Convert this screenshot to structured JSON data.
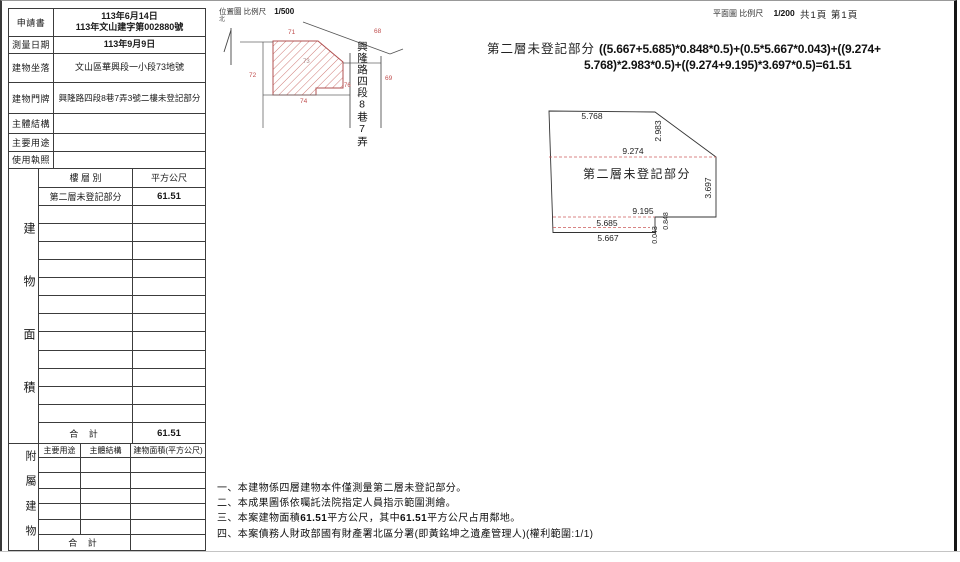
{
  "page": {
    "plan_scale_label": "平面圖 比例尺",
    "plan_scale_value": "1/200",
    "pages_label": "共1頁 第1頁"
  },
  "info_table": {
    "rows": [
      {
        "label": "申請書",
        "value_line1": "113年6月14日",
        "value_line2": "113年文山建字第002880號"
      },
      {
        "label": "測量日期",
        "value": "113年9月9日"
      },
      {
        "label": "建物坐落",
        "value": "文山區華興段一小段73地號"
      },
      {
        "label": "建物門牌",
        "value": "興隆路四段8巷7弄3號二樓未登記部分"
      },
      {
        "label": "主體結構",
        "value": ""
      },
      {
        "label": "主要用途",
        "value": ""
      },
      {
        "label": "使用執照",
        "value": ""
      }
    ]
  },
  "area_table": {
    "side_label": "建物面積",
    "col_floor": "樓 層 別",
    "col_area": "平方公尺",
    "row_floor": "第二層未登記部分",
    "row_area": "61.51",
    "total_label": "合  計",
    "total_value": "61.51"
  },
  "annex_table": {
    "side_label": "附屬建物",
    "col_use": "主要用途",
    "col_structure": "主體結構",
    "col_area": "建物面積(平方公尺)",
    "total_label": "合  計"
  },
  "location_map": {
    "title": "位置圖",
    "scale_label": "比例尺",
    "scale_value": "1/500",
    "north": "北",
    "street": "興隆路四段8巷7弄",
    "parcels": {
      "subject": "73",
      "p71": "71",
      "p72": "72",
      "p74": "74",
      "p68": "68",
      "p69": "69",
      "p76": "76"
    }
  },
  "floor_plan": {
    "region_label": "第二層未登記部分",
    "dim_top": "5.768",
    "dim_diag": "2.983",
    "dim_width_upper": "9.274",
    "dim_right": "3.697",
    "dim_width_lower": "9.195",
    "dim_mid": "5.685",
    "dim_bottom": "5.667",
    "dim_step": "0.848",
    "dim_tiny": "0.043"
  },
  "formula": {
    "label": "第二層未登記部分",
    "line1": "((5.667+5.685)*0.848*0.5)+(0.5*5.667*0.043)+((9.274+",
    "line2": "5.768)*2.983*0.5)+((9.274+9.195)*3.697*0.5)=61.51"
  },
  "notes": {
    "line1": "一、本建物係四層建物本件僅測量第二層未登記部分。",
    "line2": "二、本成果圖係依囑託法院指定人員指示範圍測繪。",
    "line3_parts": [
      "三、本案建物面積",
      "61.51",
      "平方公尺，其中",
      "61.51",
      "平方公尺占用鄰地。"
    ],
    "line4": "四、本案債務人財政部國有財產署北區分署(即黃銘坤之遺產管理人)(權利範圍:1/1)"
  }
}
